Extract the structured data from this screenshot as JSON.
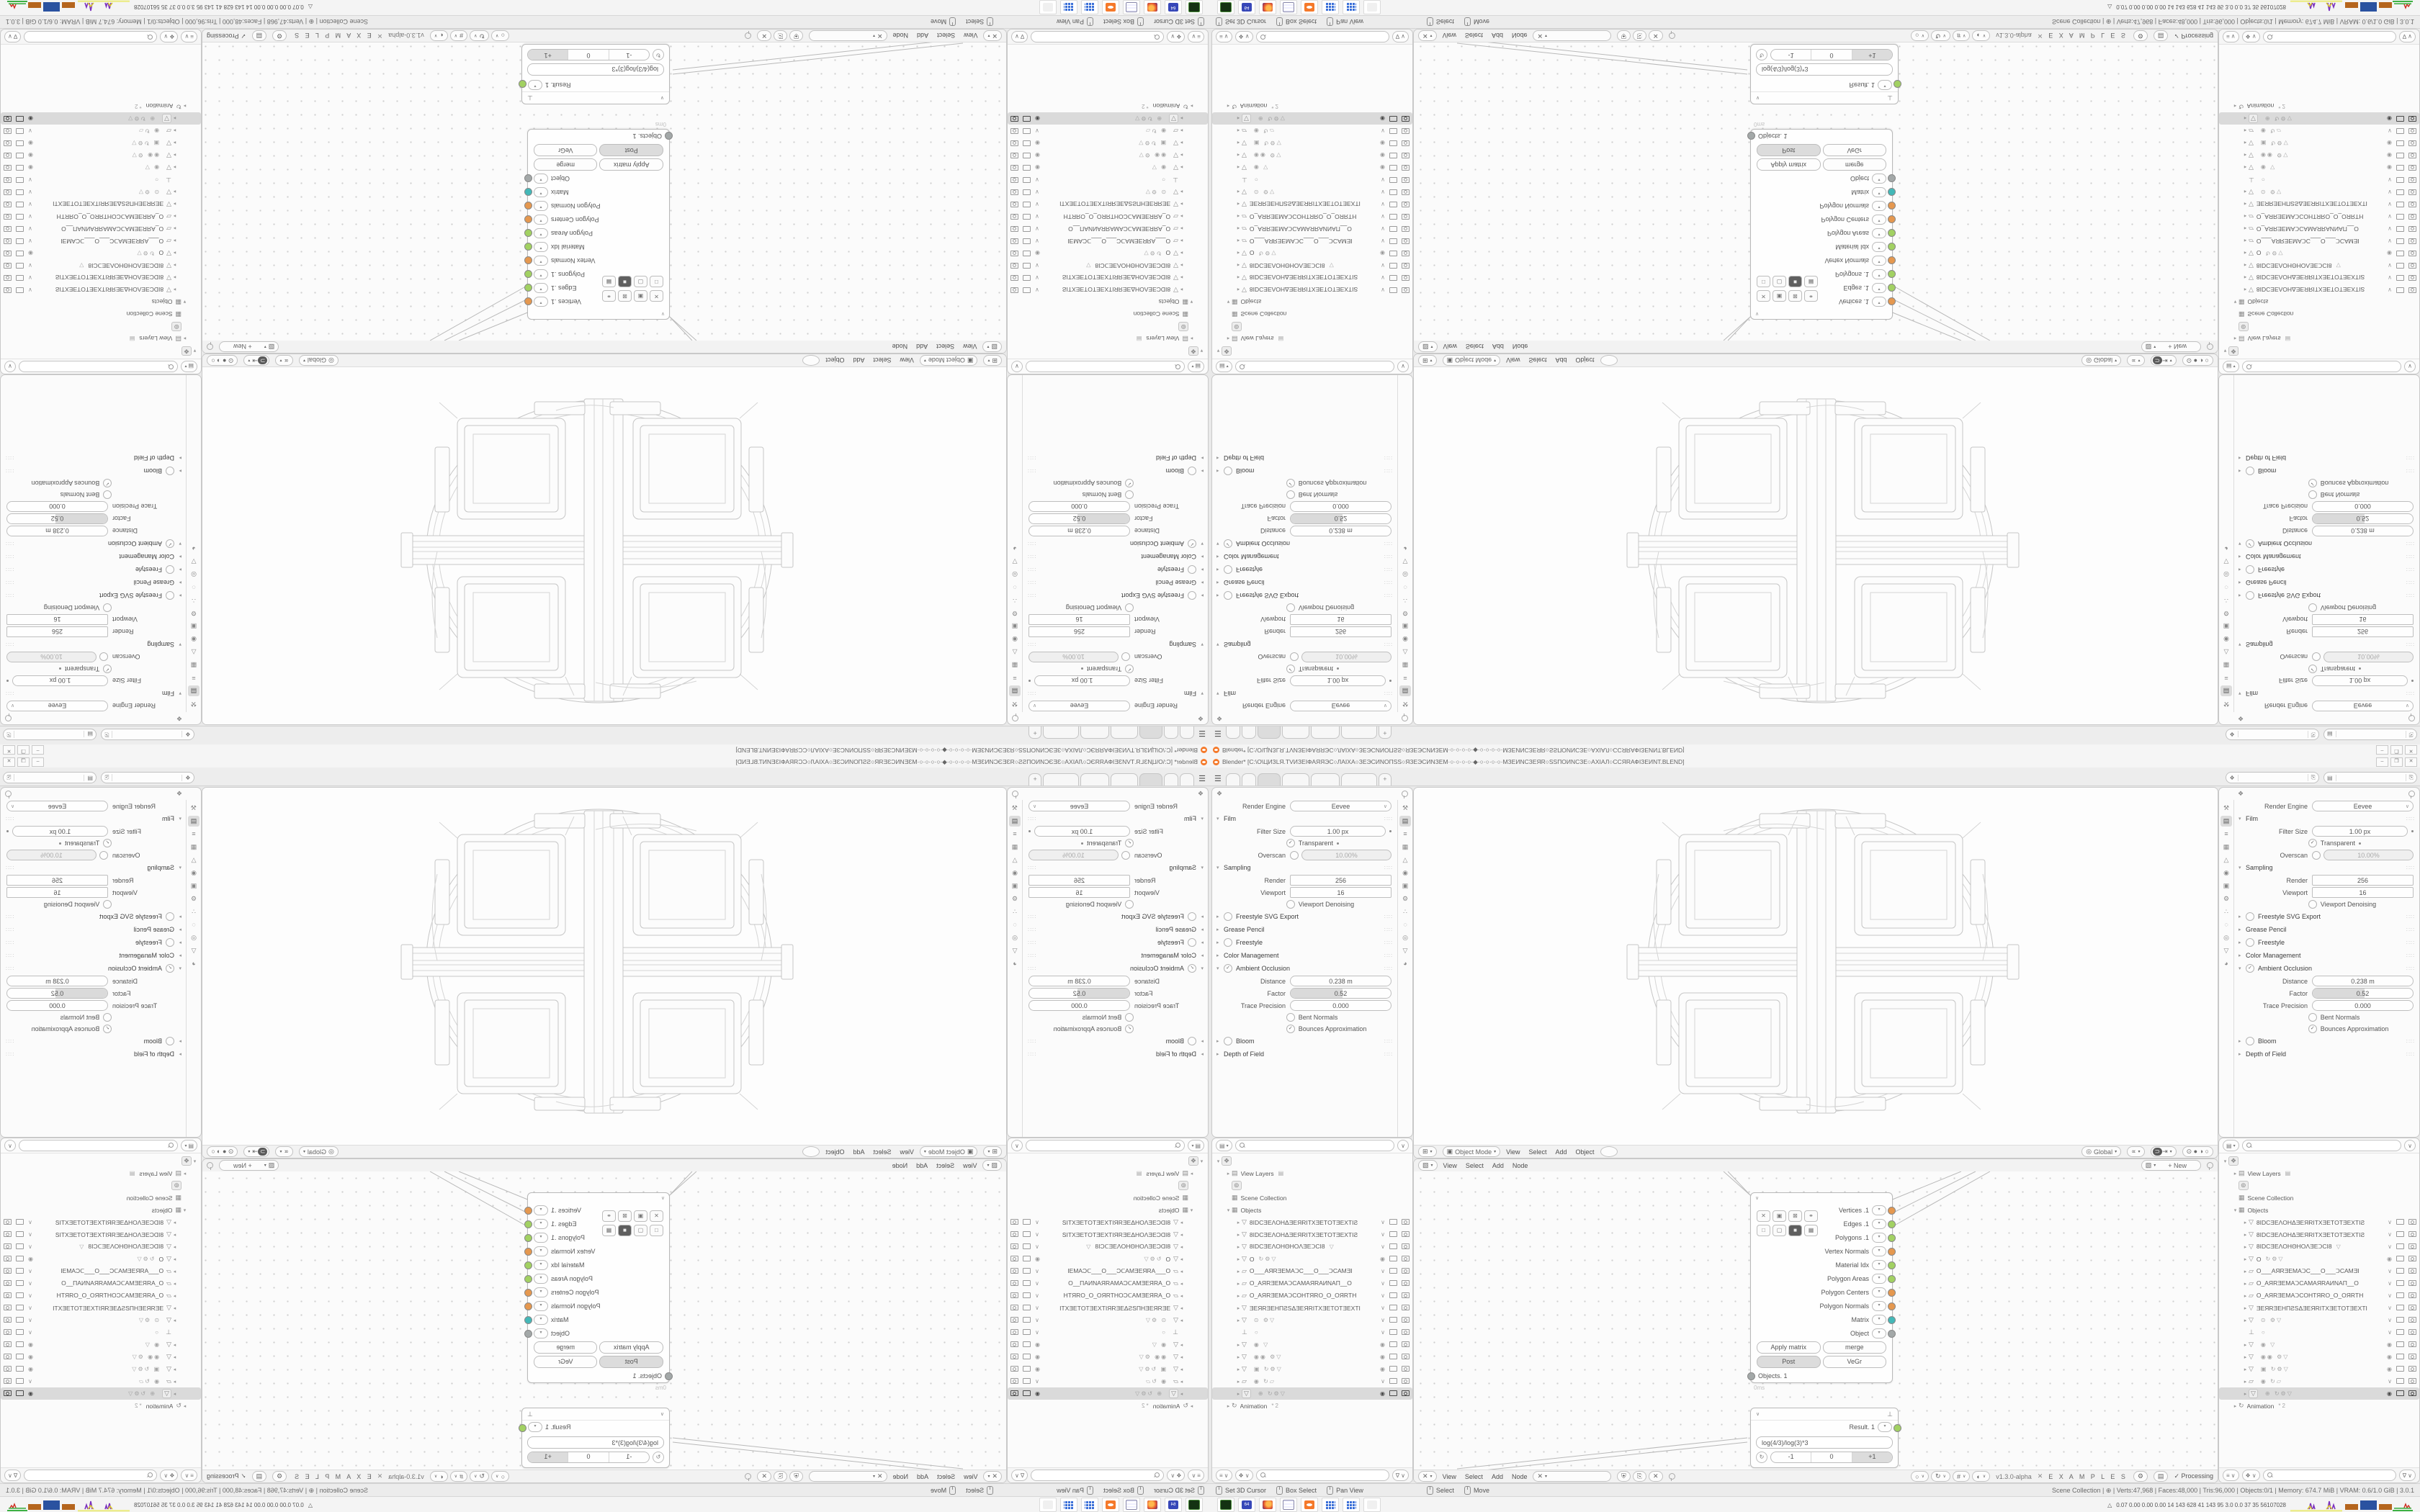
{
  "window": {
    "title": "Blender* [C:\\O\\ЦИЗLЯ.ТVИЗЕІФАЯЯЭС○ЛАІХА○ЗЕЭСИNОПЅS○ЯЗЕЭСИNЗЕМ·○·○·○·○·◆·○·○·○·○·МЗЕИNСЗЕЯR○ЅSПОИNСЗЕ○АХІАЛ○ССЯRАФІЗЕИNТ.BLEND]",
    "minimize": "–",
    "maximize": "❐",
    "close": "✕"
  },
  "topbar": {
    "tabs": [
      "",
      "",
      "",
      "",
      "",
      ""
    ],
    "active_tab": 2,
    "tab_widths": [
      18,
      18,
      30,
      36,
      38,
      48
    ],
    "new_tab_label": "+",
    "scene_selector": {
      "icon": "❖",
      "value": "",
      "copy": "⎘"
    },
    "viewlayer_selector": {
      "icon": "▤",
      "value": "",
      "copy": "⎘"
    }
  },
  "properties": {
    "header_icon": "❖",
    "nav_icons": [
      {
        "name": "tool",
        "g": "⚒"
      },
      {
        "name": "render",
        "g": "▤",
        "active": true
      },
      {
        "name": "output",
        "g": "≡"
      },
      {
        "name": "view-layer",
        "g": "▦"
      },
      {
        "name": "scene",
        "g": "△"
      },
      {
        "name": "world",
        "g": "◉"
      },
      {
        "name": "object",
        "g": "▣"
      },
      {
        "name": "modifiers",
        "g": "⚙"
      },
      {
        "name": "particles",
        "g": "∴"
      },
      {
        "name": "physics",
        "g": "◌"
      },
      {
        "name": "constraints",
        "g": "◎"
      },
      {
        "name": "data",
        "g": "▽"
      },
      {
        "name": "material",
        "g": "◕"
      }
    ],
    "rows": [
      [
        "field",
        "Render Engine",
        "Eevee",
        "dd"
      ],
      [
        "sec",
        "Film",
        "open"
      ],
      [
        "field",
        "Filter Size",
        "1.00 px",
        "dot"
      ],
      [
        "check",
        "Transparent",
        1,
        "dot"
      ],
      [
        "checkfield",
        "Overscan",
        0,
        "10.00%"
      ],
      [
        "sec",
        "Sampling",
        "open"
      ],
      [
        "fieldsq",
        "Render",
        "256"
      ],
      [
        "fieldsq",
        "Viewport",
        "16"
      ],
      [
        "check",
        "Viewport Denoising",
        0,
        ""
      ],
      [
        "secc",
        "Freestyle SVG Export",
        0
      ],
      [
        "sec",
        "Grease Pencil",
        ""
      ],
      [
        "secc",
        "Freestyle",
        0
      ],
      [
        "sec",
        "Color Management",
        ""
      ],
      [
        "secco",
        "Ambient Occlusion",
        1
      ],
      [
        "field",
        "Distance",
        "0.238 m",
        ""
      ],
      [
        "slider",
        "Factor",
        "0.52",
        52
      ],
      [
        "field",
        "Trace Precision",
        "0.000",
        ""
      ],
      [
        "check",
        "Bent Normals",
        0,
        ""
      ],
      [
        "check",
        "Bounces Approximation",
        1,
        ""
      ],
      [
        "secc",
        "Bloom",
        0
      ],
      [
        "sec",
        "Depth of Field",
        ""
      ]
    ],
    "section_dots": "∷∷"
  },
  "viewport": {
    "editor_icon": "⊞",
    "mode_icon": "▣",
    "mode": "Object Mode",
    "menus": [
      "View",
      "Select",
      "Add",
      "Object"
    ],
    "orientation_icon": "◎",
    "orientation": "Global",
    "gizmo_icon": "∝",
    "magnet_icon": "⊃",
    "snap_icon": "⇥",
    "shading_icons": "⊙ ● ◑ ○"
  },
  "node_editor": {
    "top_icon": "▧",
    "menus": [
      "View",
      "Select",
      "Add",
      "Node"
    ],
    "new_button": "+  New",
    "bottom_icon": "✕",
    "tree_field": "",
    "tree_btns": [
      "⛨",
      "⎘",
      "✕"
    ],
    "overlay_btns": [
      "○",
      "↻",
      "#",
      "◐"
    ],
    "version": "v1.3.0-alpha",
    "logo": "✕",
    "examples": "E X A M P L E S",
    "gear": "⚙",
    "page": "▤",
    "processing": "✓  Processing",
    "objects_node": {
      "collapse": "∨",
      "chips_row1": [
        "✕",
        "▣",
        "⊠",
        "⚭"
      ],
      "chips_row2": [
        "□",
        "▢",
        "■",
        "▦"
      ],
      "chips_row2_active": 2,
      "outputs": [
        {
          "label": "Vertices",
          "suffix": " .1",
          "color": "or"
        },
        {
          "label": "Edges",
          "suffix": " .1",
          "color": "gr"
        },
        {
          "label": "Polygons",
          "suffix": " .1",
          "color": "gr"
        },
        {
          "label": "Vertex Normals",
          "suffix": "",
          "color": "or"
        },
        {
          "label": "Material Idx",
          "suffix": "",
          "color": "gr"
        },
        {
          "label": "Polygon Areas",
          "suffix": "",
          "color": "gr"
        },
        {
          "label": "Polygon Centers",
          "suffix": "",
          "color": "or"
        },
        {
          "label": "Polygon Normals",
          "suffix": "",
          "color": "or"
        },
        {
          "label": "Matrix",
          "suffix": "",
          "color": "te"
        },
        {
          "label": "Object",
          "suffix": "",
          "color": "gy"
        }
      ],
      "buttons": [
        {
          "label": "Apply matrix",
          "on": false
        },
        {
          "label": "merge",
          "on": false
        },
        {
          "label": "Post",
          "on": true
        },
        {
          "label": "VeGr",
          "on": false
        }
      ],
      "input_label": "Objects. 1",
      "timing": "0ms"
    },
    "formula_node": {
      "collapse": "∨",
      "logo": "⊥",
      "output": "Result. 1",
      "output_color": "gr",
      "formula": "log(4/3)/log(3)*3",
      "refresh": "↻",
      "steps": [
        "-1",
        "0",
        "+1"
      ],
      "active_step": 2
    }
  },
  "outliner": {
    "mode_icon": "▤",
    "filter_icon": "∨",
    "foot_icons": [
      "≡",
      "❖"
    ],
    "funnel": "∇",
    "root_icon": "❖",
    "view_layers": "View Layers",
    "view_layers_icon": "▤",
    "lone_icon": "⊚",
    "scene_collection": "Scene Collection",
    "collection_icon": "▦",
    "objects": "Objects",
    "animation": "Animation",
    "animation_icon": "↻",
    "animation_suffix": "*2",
    "obj_rows": [
      {
        "g": "▽",
        "name": "8ІDCƎEΛOHΔƎEЯRІТXƎEТOТƎEXТІƧ",
        "mid": "",
        "rt": "csm",
        "arrow": 1
      },
      {
        "g": "▽",
        "name": "8ІDCƎEΛOHΔƎEЯRІТXƎEТOТƎEXТІƧ",
        "mid": "",
        "rt": "csm",
        "arrow": 1
      },
      {
        "g": "▽",
        "name": "8ІDCƎEΛOHΘHOΛƎEↃCІ8",
        "mid": "▽",
        "rt": "csm",
        "arrow": 1
      },
      {
        "g": "▽",
        "name": "O",
        "mid": "↻⚙▽",
        "rt": "esm",
        "arrow": 1
      },
      {
        "g": "▱",
        "name": "O___AЯRƎEMAↃC___O___ↃCAMƎІ",
        "mid": "",
        "rt": "csm",
        "arrow": 1
      },
      {
        "g": "▱",
        "name": "O_AЯRƎEMAↃCAMAЯRAИNAП__O",
        "mid": "",
        "rt": "csm",
        "arrow": 1
      },
      {
        "g": "▱",
        "name": "O_AЯRƎEMAↃCOHТЯRO_O_OЯRТH",
        "mid": "",
        "rt": "csm",
        "arrow": 1
      },
      {
        "g": "▽",
        "name": "ƎEЯRƎEHПƧSΔƎEЯRІТXƎEТOТƎEXТІ",
        "mid": "",
        "rt": "csm",
        "arrow": 1
      },
      {
        "g": "▽",
        "name": "",
        "mid": "⊙  ⚙▽",
        "rt": "csm",
        "arrow": 1
      },
      {
        "g": "⊥",
        "name": "",
        "mid": "○",
        "rt": "csm",
        "arrow": 0
      },
      {
        "g": "▽",
        "name": "",
        "mid": "◉  ▽",
        "rt": "esm",
        "arrow": 1
      },
      {
        "g": "▽",
        "name": "",
        "mid": "◉◉  ⚙▽",
        "rt": "esm",
        "arrow": 1
      },
      {
        "g": "▽",
        "name": "",
        "mid": "▣  ↻⚙▽",
        "rt": "esm",
        "arrow": 1
      },
      {
        "g": "▱",
        "name": "",
        "mid": "◉  ↻▱",
        "rt": "csm",
        "arrow": 1
      },
      {
        "g": "▽",
        "name": "",
        "mid": "⊕  ↻⚙▽",
        "rt": "esm",
        "arrow": 1,
        "sel": 1,
        "dark": 1
      }
    ]
  },
  "status_bar": {
    "hints": [
      "Set 3D Cursor",
      "Box Select",
      "Pan View"
    ],
    "hints2": [
      "Select",
      "Move"
    ],
    "info": "Scene Collection  |  ⊕  |  Verts:47,968  |  Faces:48,000  |  Tris:96,000  |  Objects:0/1  |  Memory: 674.7 MiB  |  VRAM: 0.6/1.0 GiB  |  3.0.1"
  },
  "taskbar": {
    "apps": [
      "screen-recorder",
      "floppy-64",
      "firefox",
      "notepad",
      "blender",
      "calculator",
      "calculator-2",
      "inactive-app"
    ],
    "floppy_label": "64",
    "tray_figure": "△",
    "tray_numbers": "0.07 0.00 0.00 0.00   14   143   628   41   143   95   3.0   0.0   37   35   56107028"
  },
  "tray_colors": {
    "yellow": "#ecec8e",
    "purple": "#7b2fbe",
    "orange": "#b5651d",
    "blue": "#2a52a0",
    "green": "#3cb043",
    "red": "#cc2a1d"
  }
}
